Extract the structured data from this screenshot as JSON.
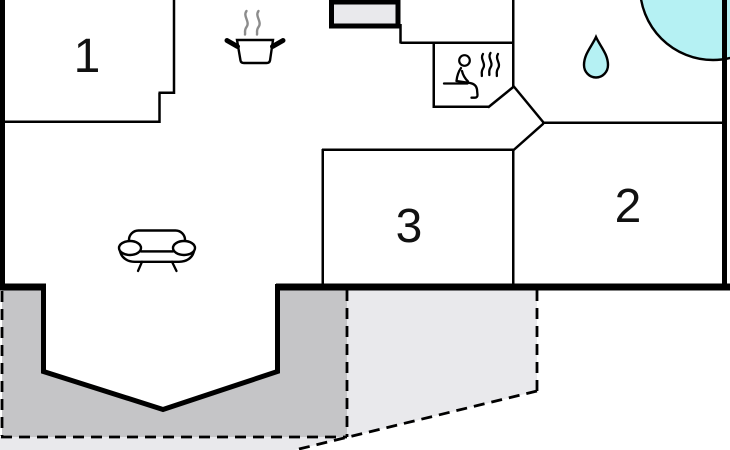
{
  "rooms": [
    {
      "label": "1"
    },
    {
      "label": "2"
    },
    {
      "label": "3"
    }
  ],
  "icons": [
    {
      "name": "stove-icon"
    },
    {
      "name": "sauna-icon"
    },
    {
      "name": "water-drop-icon"
    },
    {
      "name": "whirlpool-icon"
    },
    {
      "name": "sofa-icon"
    },
    {
      "name": "fireplace-block"
    }
  ],
  "colors": {
    "wall": "#000000",
    "water": "#b5f1f3",
    "terrace-dark": "#c5c5c7",
    "terrace-light": "#e9e9ec",
    "steam": "#8c8c8c",
    "background": "#ffffff"
  }
}
